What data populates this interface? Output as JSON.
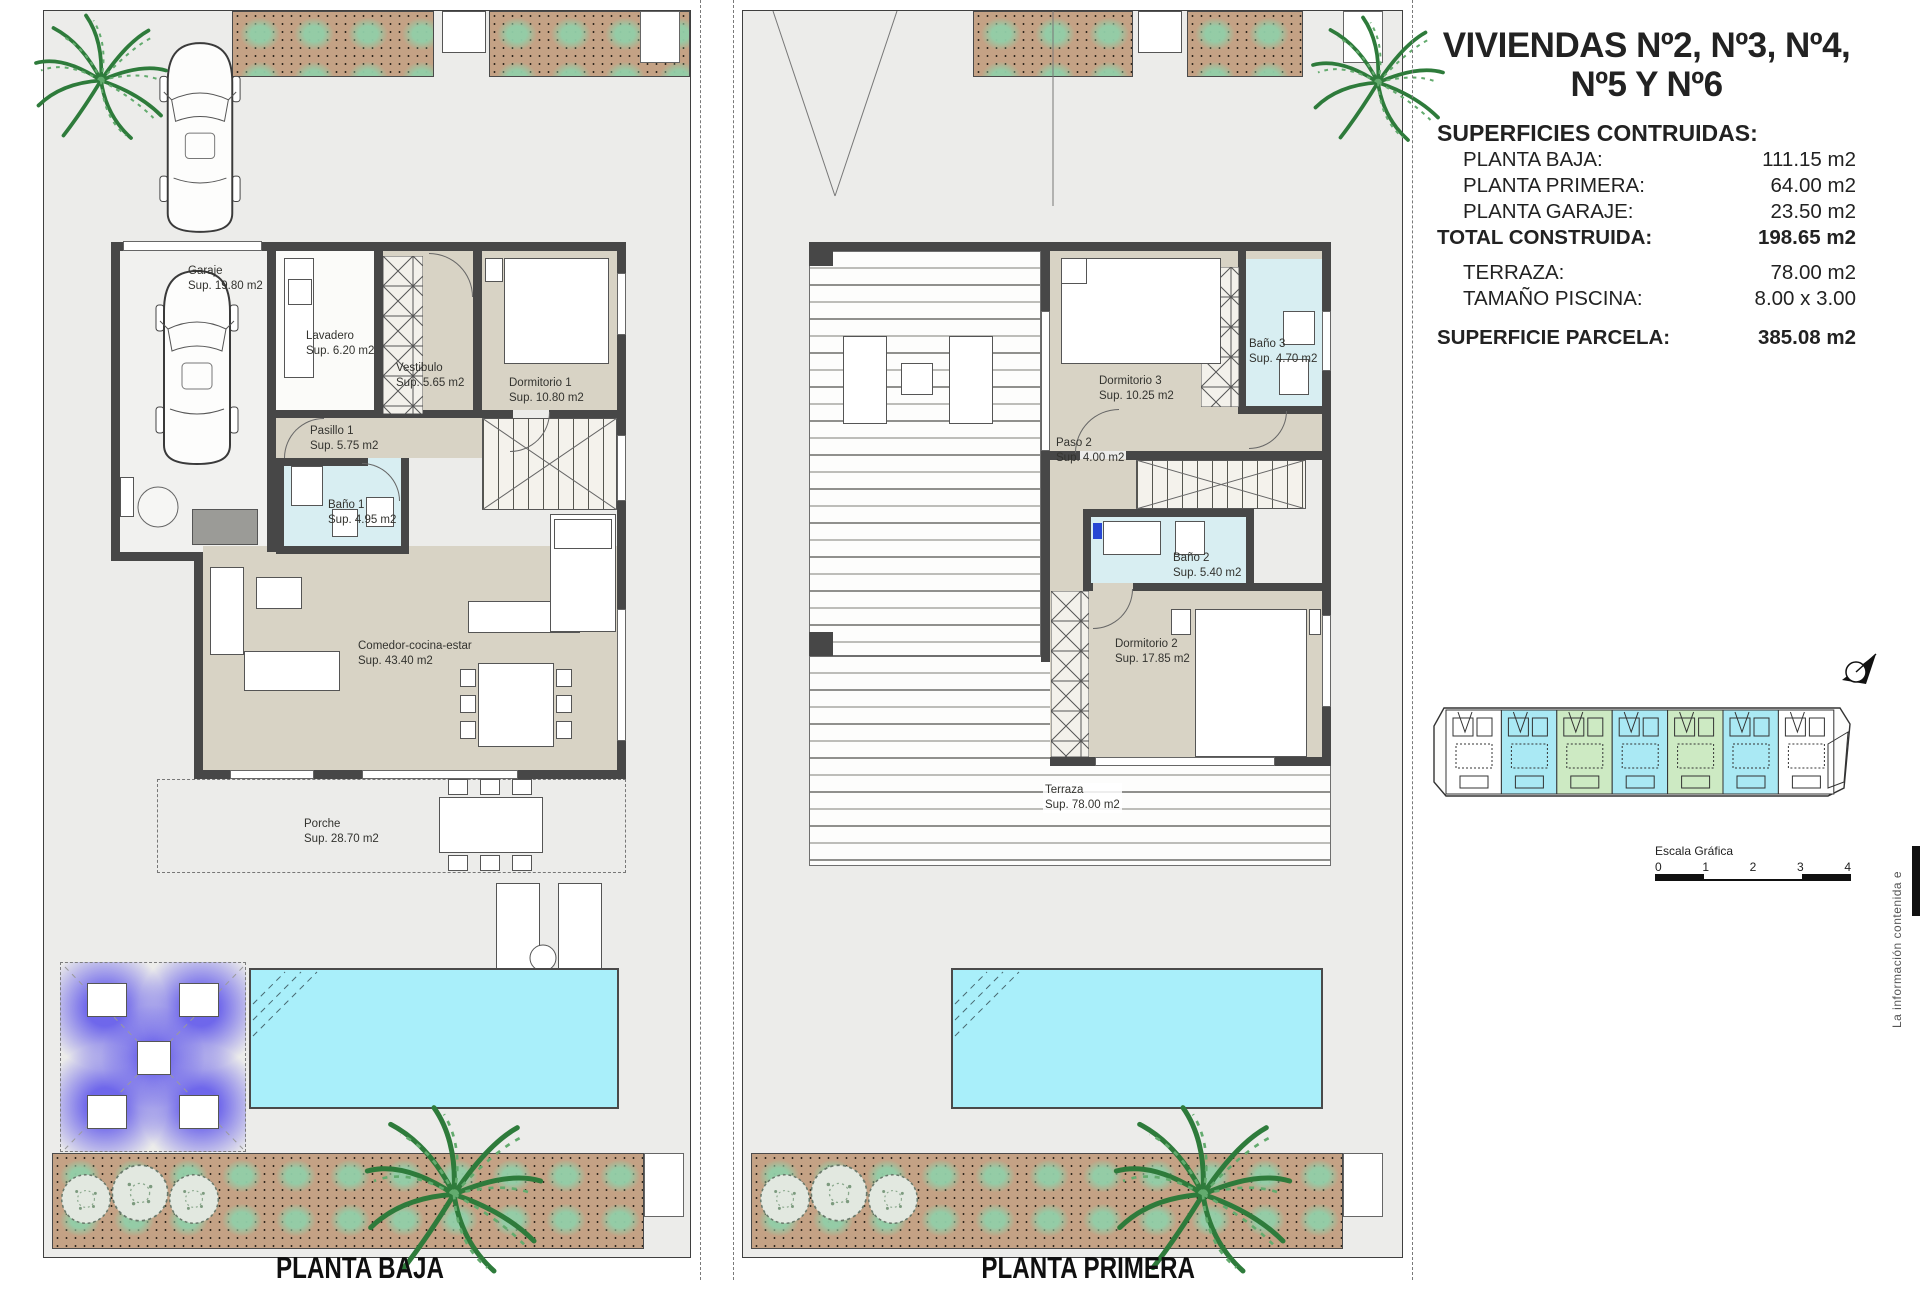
{
  "sheet": {
    "title_line1": "VIVIENDAS Nº2, Nº3, Nº4,",
    "title_line2": "Nº5 Y Nº6",
    "surfaces_heading": "SUPERFICIES CONTRUIDAS:",
    "surface_rows": [
      {
        "label": "PLANTA BAJA:",
        "value": "111.15 m2"
      },
      {
        "label": "PLANTA PRIMERA:",
        "value": "64.00 m2"
      },
      {
        "label": "PLANTA GARAJE:",
        "value": "23.50 m2"
      },
      {
        "label": "TOTAL CONSTRUIDA:",
        "value": "198.65 m2"
      },
      {
        "label": "TERRAZA:",
        "value": "78.00 m2"
      },
      {
        "label": "TAMAÑO PISCINA:",
        "value": "8.00 x 3.00"
      },
      {
        "label": "SUPERFICIE PARCELA:",
        "value": "385.08 m2"
      }
    ],
    "scale_bar": {
      "label": "Escala Gráfica",
      "ticks": [
        "0",
        "1",
        "2",
        "3",
        "4"
      ]
    },
    "side_note": "La información contenida e"
  },
  "plans": {
    "left": {
      "caption": "PLANTA BAJA",
      "rooms": [
        {
          "name": "Garaje",
          "sup": "Sup. 19.80 m2"
        },
        {
          "name": "Lavadero",
          "sup": "Sup. 6.20 m2"
        },
        {
          "name": "Vestibulo",
          "sup": "Sup. 5.65 m2"
        },
        {
          "name": "Dormitorio 1",
          "sup": "Sup. 10.80 m2"
        },
        {
          "name": "Pasillo 1",
          "sup": "Sup. 5.75 m2"
        },
        {
          "name": "Baño 1",
          "sup": "Sup. 4.95 m2"
        },
        {
          "name": "Comedor-cocina-estar",
          "sup": "Sup. 43.40 m2"
        },
        {
          "name": "Porche",
          "sup": "Sup. 28.70 m2"
        }
      ]
    },
    "right": {
      "caption": "PLANTA PRIMERA",
      "rooms": [
        {
          "name": "Dormitorio 3",
          "sup": "Sup. 10.25 m2"
        },
        {
          "name": "Baño 3",
          "sup": "Sup. 4.70 m2"
        },
        {
          "name": "Paso 2",
          "sup": "Sup. 4.00 m2"
        },
        {
          "name": "Baño 2",
          "sup": "Sup. 5.40 m2"
        },
        {
          "name": "Dormitorio 2",
          "sup": "Sup. 17.85 m2"
        },
        {
          "name": "Terraza",
          "sup": "Sup. 78.00 m2"
        }
      ]
    }
  },
  "site_plan": {
    "unit_colors": [
      "#ffffff",
      "#aae9f4",
      "#cdeac3",
      "#aae9f4",
      "#cdeac3",
      "#aae9f4",
      "#ffffff"
    ]
  },
  "colors": {
    "wall": "#474747",
    "floor_beige": "#d8d3c5",
    "bath_blue": "#d8eef2",
    "pool_cyan": "#a9effa",
    "garden_brown": "#c4a285",
    "plant_green": "#8cc9a0",
    "glow_purple": "#6860eb"
  }
}
